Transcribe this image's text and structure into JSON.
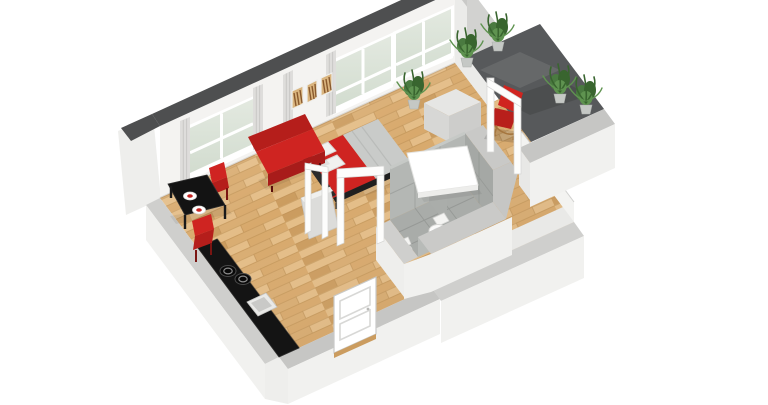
{
  "scene": {
    "title": "3D isometric cutaway floor plan rendering of a small studio apartment",
    "type": "architectural-3d-floor-plan",
    "view": "isometric cutaway seen from the south-west, white background",
    "background": "#ffffff"
  },
  "palette": {
    "bg": "#ffffff",
    "wallTop": "#4e4f50",
    "wallFace": "#f4f3f1",
    "wallFaceShade": "#ebebe9",
    "wallOuter": "#f1f1ef",
    "wallOuterSoft": "#eeeeec",
    "wallBand": "#cfcfcd",
    "wallBandDark": "#c6c6c4",
    "eastOuter": "#d2d2d0",
    "capBand": "#c9c9c7",
    "woodBase": "#d9ad72",
    "woodLight": "#e4bd87",
    "woodMid": "#d8a96c",
    "woodDark": "#cb9c5f",
    "woodJoint": "#bd9055",
    "balconyFloor": "#57595b",
    "tileFloor": "#a9aca9",
    "tileWall": "#b4b7b4",
    "tileWallDark": "#a5a8a5",
    "tileJoint": "#8f928f",
    "divider": "#aaadaa",
    "accentRed": "#cf2421",
    "accentRedDark": "#a81c1a",
    "accentRedDeep": "#b51e1b",
    "black": "#141414",
    "blackSoft": "#161616",
    "glassTop": "#e3e9e0",
    "glassBottom": "#d2dccf",
    "curtain": "#dedddb",
    "curtainPleat": "#c9c8c6",
    "plantDark": "#39652f",
    "plantMid": "#4a7a40",
    "plantLight": "#5f9350",
    "potGray": "#c5c8c5",
    "grayBox": "#dcdcda",
    "dresserTop": "#e6e6e4",
    "dresserFront": "#d7d7d5",
    "dresserSide": "#cdcdcb",
    "pillow": "#f1f1ef",
    "pillowShade": "#d8d8d6",
    "bedRunner": "#c9cbc9",
    "bedFrame": "#1f1f1f",
    "frameWhite": "#fdfdfc",
    "frameStroke": "#d5d5d3",
    "picWood": "#d9b47e",
    "picStroke": "#8a5a2e",
    "ceramic": "#fbfbfa",
    "ceramicShade": "#d8d8d6",
    "woodChair": "#a5763f"
  },
  "rooms": [
    {
      "id": "living-bedroom",
      "name": "Living and sleeping area",
      "floor": "light oak parquet",
      "furniture": [
        "double bed with red blanket, grey runner and two white pillows",
        "red two-seat sofa",
        "white side table",
        "light grey dresser",
        "potted plant",
        "three wooden wall pictures",
        "two glass partition door frames",
        "low grey cabinet"
      ]
    },
    {
      "id": "kitchen-dining",
      "name": "Kitchen and dining corner",
      "floor": "light oak parquet",
      "furniture": [
        "black kitchen counter with two burners and square sink",
        "black dining table",
        "two red dining chairs",
        "two white place settings"
      ]
    },
    {
      "id": "bathroom",
      "name": "Bathroom",
      "floor": "grey tiles",
      "furniture": [
        "toilet",
        "bidet",
        "grey tiled half walls",
        "tiled partition fin"
      ]
    },
    {
      "id": "balcony",
      "name": "Balcony terrace",
      "floor": "dark grey concrete slab",
      "furniture": [
        "red lounge chair with wooden frame",
        "four potted plants",
        "white balcony door frame",
        "light grey parapet wall"
      ]
    },
    {
      "id": "entry",
      "name": "Entry",
      "floor": "light oak parquet",
      "furniture": [
        "white panelled front door"
      ]
    }
  ],
  "structure": {
    "windows": 3,
    "wall_pictures": 3,
    "door_frames": 3,
    "plants_total": 5,
    "cut_wall_note": "rear walls full height with dark grey cut top, front walls cut low with light grey top bands"
  }
}
